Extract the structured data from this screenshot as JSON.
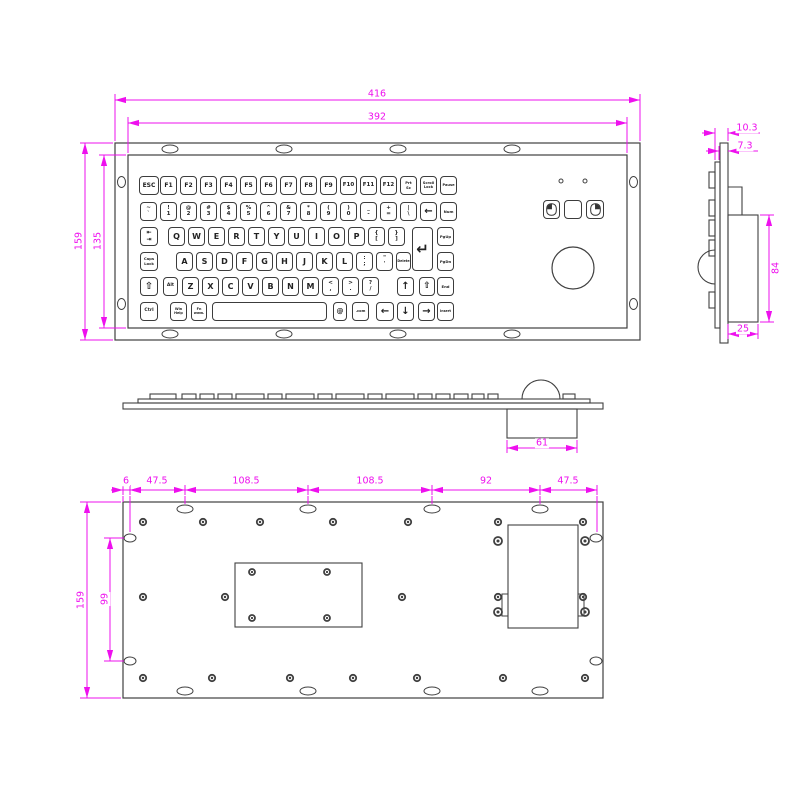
{
  "drawing": {
    "type": "technical-drawing",
    "subject": "panel-mount industrial keyboard with trackball",
    "colors": {
      "line": "#404040",
      "dimension": "#ee10ee",
      "background": "#ffffff"
    }
  },
  "dims": {
    "front_outer_w": "416",
    "front_inner_w": "392",
    "front_outer_h": "159",
    "front_inner_h": "135",
    "side_total_depth": "10.3",
    "side_key_depth": "7.3",
    "side_box_h": "84",
    "side_box_d": "25",
    "profile_box_w": "61",
    "back_d1": "6",
    "back_d2": "47.5",
    "back_d3": "108.5",
    "back_d4": "108.5",
    "back_d5": "92",
    "back_d6": "47.5",
    "back_h": "159",
    "back_hole_span": "99"
  },
  "mouse": {
    "led_count": 2,
    "buttons": [
      "mouse-left-button",
      "mouse-middle-button",
      "mouse-right-button"
    ],
    "icons": [
      "mouse-left-icon",
      "mouse-right-icon"
    ],
    "trackball": "trackball"
  },
  "keyboard": {
    "key_h": 19,
    "row_y": [
      176,
      202,
      227,
      252,
      277,
      302,
      200
    ],
    "rows": [
      {
        "keys": [
          {
            "id": "esc",
            "t": "ESC",
            "x": 139,
            "w": 20,
            "fs": 6
          },
          {
            "id": "f1",
            "t": "F1",
            "x": 160,
            "w": 17,
            "fs": 6
          },
          {
            "id": "f2",
            "t": "F2",
            "x": 180,
            "w": 17,
            "fs": 6
          },
          {
            "id": "f3",
            "t": "F3",
            "x": 200,
            "w": 17,
            "fs": 6
          },
          {
            "id": "f4",
            "t": "F4",
            "x": 220,
            "w": 17,
            "fs": 6
          },
          {
            "id": "f5",
            "t": "F5",
            "x": 240,
            "w": 17,
            "fs": 6
          },
          {
            "id": "f6",
            "t": "F6",
            "x": 260,
            "w": 17,
            "fs": 6
          },
          {
            "id": "f7",
            "t": "F7",
            "x": 280,
            "w": 17,
            "fs": 6
          },
          {
            "id": "f8",
            "t": "F8",
            "x": 300,
            "w": 17,
            "fs": 6
          },
          {
            "id": "f9",
            "t": "F9",
            "x": 320,
            "w": 17,
            "fs": 6
          },
          {
            "id": "f10",
            "t": "F10",
            "x": 340,
            "w": 17,
            "fs": 5.5
          },
          {
            "id": "f11",
            "t": "F11",
            "x": 360,
            "w": 17,
            "fs": 5.5
          },
          {
            "id": "f12",
            "t": "F12",
            "x": 380,
            "w": 17,
            "fs": 5.5
          },
          {
            "id": "prt-sc",
            "l": [
              "Prt",
              "Sc"
            ],
            "x": 400,
            "w": 17,
            "fs": 3.8
          },
          {
            "id": "scroll-lock",
            "l": [
              "Scroll",
              "Lock"
            ],
            "x": 420,
            "w": 17,
            "fs": 3.6
          },
          {
            "id": "pause",
            "t": "Pause",
            "x": 440,
            "w": 17,
            "fs": 3.6
          }
        ]
      },
      {
        "keys": [
          {
            "id": "backquote",
            "l": [
              "~",
              "`"
            ],
            "x": 140,
            "w": 17,
            "fs": 5.5
          },
          {
            "id": "1",
            "l": [
              "!",
              "1"
            ],
            "x": 160,
            "w": 17,
            "fs": 5.5
          },
          {
            "id": "2",
            "l": [
              "@",
              "2"
            ],
            "x": 180,
            "w": 17,
            "fs": 5.5
          },
          {
            "id": "3",
            "l": [
              "#",
              "3"
            ],
            "x": 200,
            "w": 17,
            "fs": 5.5
          },
          {
            "id": "4",
            "l": [
              "$",
              "4"
            ],
            "x": 220,
            "w": 17,
            "fs": 5.5
          },
          {
            "id": "5",
            "l": [
              "%",
              "5"
            ],
            "x": 240,
            "w": 17,
            "fs": 5.5
          },
          {
            "id": "6",
            "l": [
              "^",
              "6"
            ],
            "x": 260,
            "w": 17,
            "fs": 5.5
          },
          {
            "id": "7",
            "l": [
              "&",
              "7"
            ],
            "x": 280,
            "w": 17,
            "fs": 5.5
          },
          {
            "id": "8",
            "l": [
              "*",
              "8"
            ],
            "x": 300,
            "w": 17,
            "fs": 5.5
          },
          {
            "id": "9",
            "l": [
              "(",
              "9"
            ],
            "x": 320,
            "w": 17,
            "fs": 5.5
          },
          {
            "id": "0",
            "l": [
              ")",
              "0"
            ],
            "x": 340,
            "w": 17,
            "fs": 5.5
          },
          {
            "id": "minus",
            "l": [
              "_",
              "-"
            ],
            "x": 360,
            "w": 17,
            "fs": 5.5
          },
          {
            "id": "equals",
            "l": [
              "+",
              "="
            ],
            "x": 380,
            "w": 17,
            "fs": 5.5
          },
          {
            "id": "backslash",
            "l": [
              "|",
              "\\"
            ],
            "x": 400,
            "w": 17,
            "fs": 5.5
          },
          {
            "id": "backspace",
            "t": "←",
            "x": 420,
            "w": 17,
            "fs": 10,
            "cls": "b"
          },
          {
            "id": "num",
            "t": "Num",
            "x": 440,
            "w": 17,
            "fs": 3.8
          }
        ]
      },
      {
        "keys": [
          {
            "id": "tab",
            "l": [
              "⇤",
              "⇥"
            ],
            "x": 140,
            "w": 18,
            "fs": 6
          },
          {
            "id": "q",
            "t": "Q",
            "x": 168,
            "w": 17
          },
          {
            "id": "w",
            "t": "W",
            "x": 188,
            "w": 17
          },
          {
            "id": "e",
            "t": "E",
            "x": 208,
            "w": 17
          },
          {
            "id": "r",
            "t": "R",
            "x": 228,
            "w": 17
          },
          {
            "id": "t",
            "t": "T",
            "x": 248,
            "w": 17
          },
          {
            "id": "y",
            "t": "Y",
            "x": 268,
            "w": 17
          },
          {
            "id": "u",
            "t": "U",
            "x": 288,
            "w": 17
          },
          {
            "id": "i",
            "t": "I",
            "x": 308,
            "w": 17
          },
          {
            "id": "o",
            "t": "O",
            "x": 328,
            "w": 17
          },
          {
            "id": "p",
            "t": "P",
            "x": 348,
            "w": 17
          },
          {
            "id": "bracket-left",
            "l": [
              "{",
              "["
            ],
            "x": 368,
            "w": 17,
            "fs": 5.5
          },
          {
            "id": "bracket-right",
            "l": [
              "}",
              "]"
            ],
            "x": 388,
            "w": 17,
            "fs": 5.5
          },
          {
            "id": "enter",
            "t": "↵",
            "x": 412,
            "w": 21,
            "h": 44,
            "fs": 15,
            "cls": "b"
          },
          {
            "id": "pgup",
            "t": "PgUp",
            "x": 437,
            "w": 17,
            "fs": 3.8
          }
        ]
      },
      {
        "keys": [
          {
            "id": "caps-lock",
            "l": [
              "Caps",
              "Lock"
            ],
            "x": 140,
            "w": 18,
            "fs": 3.8
          },
          {
            "id": "a",
            "t": "A",
            "x": 176,
            "w": 17
          },
          {
            "id": "s",
            "t": "S",
            "x": 196,
            "w": 17
          },
          {
            "id": "d",
            "t": "D",
            "x": 216,
            "w": 17
          },
          {
            "id": "f",
            "t": "F",
            "x": 236,
            "w": 17
          },
          {
            "id": "g",
            "t": "G",
            "x": 256,
            "w": 17
          },
          {
            "id": "h",
            "t": "H",
            "x": 276,
            "w": 17
          },
          {
            "id": "j",
            "t": "J",
            "x": 296,
            "w": 17
          },
          {
            "id": "k",
            "t": "K",
            "x": 316,
            "w": 17
          },
          {
            "id": "l",
            "t": "L",
            "x": 336,
            "w": 17
          },
          {
            "id": "semicolon",
            "l": [
              ":",
              ";"
            ],
            "x": 356,
            "w": 17,
            "fs": 5.5
          },
          {
            "id": "quote",
            "l": [
              "\"",
              "'"
            ],
            "x": 376,
            "w": 17,
            "fs": 5.5
          },
          {
            "id": "delete",
            "t": "Delete",
            "x": 396,
            "w": 15,
            "fs": 3.3
          },
          {
            "id": "pgdn",
            "t": "PgDn",
            "x": 437,
            "w": 17,
            "fs": 3.8
          }
        ]
      },
      {
        "keys": [
          {
            "id": "shift-left",
            "t": "⇧",
            "x": 140,
            "w": 18,
            "fs": 10
          },
          {
            "id": "alt",
            "t": "Alt",
            "x": 163,
            "w": 15,
            "fs": 4.5
          },
          {
            "id": "z",
            "t": "Z",
            "x": 182,
            "w": 17
          },
          {
            "id": "x",
            "t": "X",
            "x": 202,
            "w": 17
          },
          {
            "id": "c",
            "t": "C",
            "x": 222,
            "w": 17
          },
          {
            "id": "v",
            "t": "V",
            "x": 242,
            "w": 17
          },
          {
            "id": "b",
            "t": "B",
            "x": 262,
            "w": 17
          },
          {
            "id": "n",
            "t": "N",
            "x": 282,
            "w": 17
          },
          {
            "id": "m",
            "t": "M",
            "x": 302,
            "w": 17
          },
          {
            "id": "comma",
            "l": [
              "<",
              ","
            ],
            "x": 322,
            "w": 17,
            "fs": 5.5
          },
          {
            "id": "period",
            "l": [
              ">",
              "."
            ],
            "x": 342,
            "w": 17,
            "fs": 5.5
          },
          {
            "id": "slash",
            "l": [
              "?",
              "/"
            ],
            "x": 362,
            "w": 17,
            "fs": 5.5
          },
          {
            "id": "arrow-up",
            "t": "↑",
            "x": 397,
            "w": 17,
            "fs": 10,
            "cls": "b"
          },
          {
            "id": "shift-right",
            "t": "⇧",
            "x": 419,
            "w": 16,
            "fs": 9
          },
          {
            "id": "end",
            "t": "End",
            "x": 437,
            "w": 17,
            "fs": 3.8
          }
        ]
      },
      {
        "keys": [
          {
            "id": "ctrl",
            "t": "Ctrl",
            "x": 140,
            "w": 18,
            "fs": 4.5
          },
          {
            "id": "win-help",
            "l": [
              "Win",
              "Help"
            ],
            "x": 170,
            "w": 17,
            "fs": 3.4
          },
          {
            "id": "fn-www",
            "l": [
              "Fn",
              "www."
            ],
            "x": 191,
            "w": 16,
            "fs": 3.4
          },
          {
            "id": "space",
            "t": "",
            "x": 212,
            "w": 115
          },
          {
            "id": "at",
            "t": "@",
            "x": 333,
            "w": 14,
            "fs": 7
          },
          {
            "id": "dot-com",
            "t": ".com",
            "x": 352,
            "w": 17,
            "fs": 3.6
          },
          {
            "id": "arrow-left",
            "t": "←",
            "x": 376,
            "w": 18,
            "fs": 10,
            "cls": "b"
          },
          {
            "id": "arrow-down",
            "t": "↓",
            "x": 397,
            "w": 17,
            "fs": 10,
            "cls": "b"
          },
          {
            "id": "arrow-right",
            "t": "→",
            "x": 418,
            "w": 17,
            "fs": 10,
            "cls": "b"
          },
          {
            "id": "insert",
            "t": "Insert",
            "x": 437,
            "w": 17,
            "fs": 3.3
          }
        ]
      },
      {
        "keys": [
          {
            "id": "mouse-left-button",
            "icon": "mouse-left-icon",
            "x": 543,
            "w": 17
          },
          {
            "id": "mouse-middle-button",
            "t": "",
            "x": 564,
            "w": 18
          },
          {
            "id": "mouse-right-button",
            "icon": "mouse-right-icon",
            "x": 586,
            "w": 18
          }
        ]
      }
    ]
  }
}
